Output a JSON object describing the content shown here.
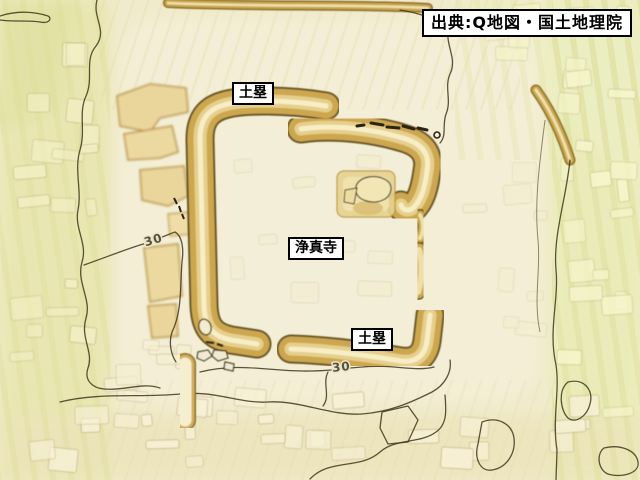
{
  "map": {
    "source_label": "出典:Q地図・国土地理院",
    "labels": {
      "dorui_top": "土塁",
      "joshinji": "浄真寺",
      "dorui_bottom": "土塁"
    },
    "contour_labels": {
      "west": "30",
      "south": "30"
    },
    "colors": {
      "terrain_base": "#f1ebcd",
      "lowland_green": "#e8e6ae",
      "rampart_gold": "#cda74f",
      "rampart_crest": "#f7eec6",
      "rampart_rim": "#5f4d1d",
      "contour_line": "#3f361d",
      "label_background": "#ffffff",
      "label_border": "#000000"
    }
  }
}
